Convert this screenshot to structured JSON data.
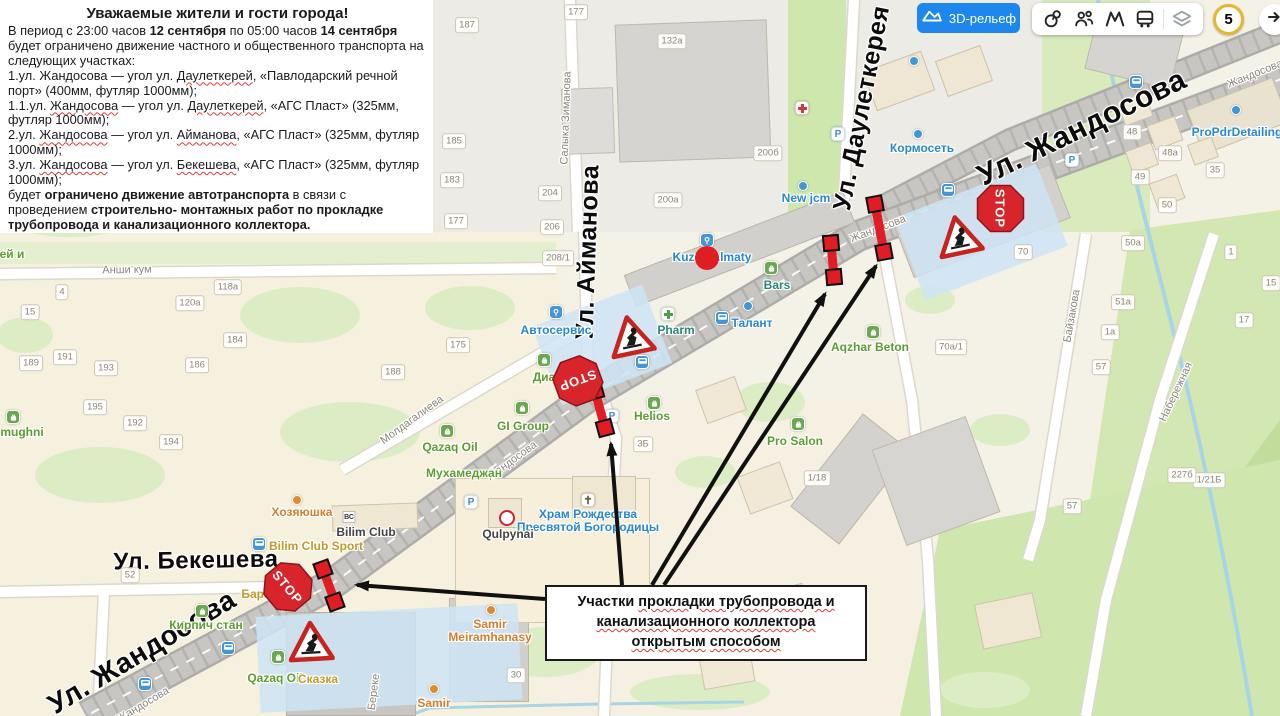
{
  "notice": {
    "title": "Уважаемые жители и гости города!",
    "paragraphs": [
      [
        {
          "t": "В период с 23:00 часов "
        },
        {
          "t": "12 сентября",
          "b": true
        },
        {
          "t": " по 05:00 часов  "
        },
        {
          "t": "14 сентября",
          "b": true
        },
        {
          "t": " будет ограничено движение частного и общественного транспорта на следующих участках:"
        }
      ],
      [
        {
          "t": "1.ул. Жандосова — угол ул. "
        },
        {
          "t": "Даулеткерей",
          "w": true
        },
        {
          "t": ", «Павлодарский речной порт» (400мм, футляр 1000мм);"
        }
      ],
      [
        {
          "t": "1.1.ул. "
        },
        {
          "t": "Жандосова",
          "w": true
        },
        {
          "t": " — угол ул. "
        },
        {
          "t": "Даулеткерей",
          "w": true
        },
        {
          "t": ", «АГС Пласт» (325мм, футляр 1000мм);"
        }
      ],
      [
        {
          "t": "2.ул. "
        },
        {
          "t": "Жандосова",
          "w": true
        },
        {
          "t": " — угол ул. "
        },
        {
          "t": "Айманова",
          "w": true
        },
        {
          "t": ", «АГС Пласт» (325мм, футляр 1000мм);"
        }
      ],
      [
        {
          "t": "3.ул. "
        },
        {
          "t": "Жандосова",
          "w": true
        },
        {
          "t": " — угол ул. "
        },
        {
          "t": "Бекешева",
          "w": true
        },
        {
          "t": ", «АГС Пласт» (325мм, футляр 1000мм);"
        }
      ],
      [
        {
          "t": "будет "
        },
        {
          "t": "ограничено движение автотранспорта",
          "b": true
        },
        {
          "t": " в связи с проведением "
        },
        {
          "t": "строительно- монтажных работ по прокладке трубопровода и канализационного коллектора.",
          "b": true
        }
      ]
    ]
  },
  "callout": {
    "lines": [
      [
        {
          "t": "Участки "
        },
        {
          "t": "прокладки трубопровода и",
          "w": true
        }
      ],
      [
        {
          "t": "канализационного коллектора",
          "w": true
        }
      ],
      [
        {
          "t": "открытым",
          "w": true
        },
        {
          "t": "  "
        },
        {
          "t": "способом",
          "w": true
        }
      ]
    ]
  },
  "toolbar": {
    "relief_label": "3D-рельеф",
    "badge_count": "5",
    "accent_blue": "#1d87ee",
    "badge_ring": "#e8b62a",
    "icons": [
      "landmarks",
      "friends",
      "metro",
      "transport",
      "layers"
    ]
  },
  "map": {
    "colors": {
      "closure_red": "#e01d23",
      "sign_red": "#d8242b",
      "arrow_black": "#111111",
      "poi_blue": "#2788cc",
      "poi_teal": "#28857a",
      "poi_green": "#5d9c30",
      "poi_yellow": "#c19a2a",
      "poi_orange": "#d07f2e",
      "poi_dark": "#444444"
    },
    "street_labels_major": [
      {
        "t": "Ул. Жандосова",
        "x": 1082,
        "y": 128,
        "r": -26,
        "s": 30
      },
      {
        "t": "Ул. Даулеткерея",
        "x": 862,
        "y": 108,
        "r": -79,
        "s": 25
      },
      {
        "t": "Ул. Айманова",
        "x": 588,
        "y": 252,
        "r": -88,
        "s": 25
      },
      {
        "t": "Ул. Бекешева",
        "x": 196,
        "y": 561,
        "r": -1,
        "s": 24
      },
      {
        "t": "Ул. Жандосова",
        "x": 142,
        "y": 652,
        "r": -31,
        "s": 28
      }
    ],
    "street_labels_minor": [
      {
        "t": "Жандосова",
        "x": 1255,
        "y": 74,
        "r": -22
      },
      {
        "t": "Жандосова",
        "x": 878,
        "y": 229,
        "r": -21
      },
      {
        "t": "Жандосова",
        "x": 512,
        "y": 461,
        "r": -36
      },
      {
        "t": "Жандосова",
        "x": 143,
        "y": 705,
        "r": -31
      },
      {
        "t": "Салыка Зиманова",
        "x": 566,
        "y": 118,
        "r": -88
      },
      {
        "t": "Анши кум",
        "x": 127,
        "y": 270,
        "r": -1
      },
      {
        "t": "Молдагалиева",
        "x": 412,
        "y": 420,
        "r": -36
      },
      {
        "t": "Байзакова",
        "x": 1072,
        "y": 316,
        "r": -80
      },
      {
        "t": "Набережная",
        "x": 1176,
        "y": 392,
        "r": -65
      },
      {
        "t": "Береке",
        "x": 374,
        "y": 692,
        "r": -83
      }
    ],
    "house_numbers": [
      {
        "n": "187",
        "x": 467,
        "y": 25
      },
      {
        "n": "185",
        "x": 454,
        "y": 141
      },
      {
        "n": "183",
        "x": 452,
        "y": 180
      },
      {
        "n": "177",
        "x": 456,
        "y": 221
      },
      {
        "n": "177",
        "x": 576,
        "y": 12
      },
      {
        "n": "132a",
        "x": 672,
        "y": 41
      },
      {
        "n": "200a",
        "x": 668,
        "y": 200
      },
      {
        "n": "200б",
        "x": 768,
        "y": 153
      },
      {
        "n": "204",
        "x": 550,
        "y": 193
      },
      {
        "n": "206",
        "x": 552,
        "y": 227
      },
      {
        "n": "208/1",
        "x": 558,
        "y": 258
      },
      {
        "n": "175",
        "x": 458,
        "y": 345
      },
      {
        "n": "188",
        "x": 393,
        "y": 372
      },
      {
        "n": "4",
        "x": 62,
        "y": 292
      },
      {
        "n": "15",
        "x": 30,
        "y": 312
      },
      {
        "n": "118a",
        "x": 228,
        "y": 287
      },
      {
        "n": "120a",
        "x": 190,
        "y": 303
      },
      {
        "n": "184",
        "x": 235,
        "y": 340
      },
      {
        "n": "189",
        "x": 31,
        "y": 363
      },
      {
        "n": "191",
        "x": 65,
        "y": 357
      },
      {
        "n": "193",
        "x": 106,
        "y": 368
      },
      {
        "n": "186",
        "x": 197,
        "y": 365
      },
      {
        "n": "195",
        "x": 95,
        "y": 407
      },
      {
        "n": "192",
        "x": 135,
        "y": 423
      },
      {
        "n": "194",
        "x": 171,
        "y": 442
      },
      {
        "n": "52",
        "x": 130,
        "y": 575
      },
      {
        "n": "48",
        "x": 1132,
        "y": 132
      },
      {
        "n": "48a",
        "x": 1170,
        "y": 153
      },
      {
        "n": "49",
        "x": 1140,
        "y": 177
      },
      {
        "n": "35",
        "x": 1215,
        "y": 170
      },
      {
        "n": "50",
        "x": 1167,
        "y": 205
      },
      {
        "n": "70",
        "x": 1023,
        "y": 252
      },
      {
        "n": "70a/1",
        "x": 951,
        "y": 347
      },
      {
        "n": "1/21Б",
        "x": 1209,
        "y": 480
      },
      {
        "n": "1/18",
        "x": 817,
        "y": 478
      },
      {
        "n": "3Б",
        "x": 643,
        "y": 444
      },
      {
        "n": "50a",
        "x": 1133,
        "y": 243
      },
      {
        "n": "51a",
        "x": 1123,
        "y": 302
      },
      {
        "n": "1a",
        "x": 1110,
        "y": 332
      },
      {
        "n": "57",
        "x": 1101,
        "y": 367
      },
      {
        "n": "1",
        "x": 1231,
        "y": 252
      },
      {
        "n": "15",
        "x": 1271,
        "y": 283
      },
      {
        "n": "17",
        "x": 1244,
        "y": 320
      },
      {
        "n": "227б",
        "x": 1182,
        "y": 475
      },
      {
        "n": "57",
        "x": 1072,
        "y": 506
      },
      {
        "n": "30",
        "x": 516,
        "y": 675
      }
    ],
    "pois": [
      {
        "t": "ProPdrDetailing",
        "x": 1237,
        "y": 126,
        "c": "blue"
      },
      {
        "t": "Кормосеть",
        "x": 922,
        "y": 142,
        "c": "blue"
      },
      {
        "t": "New jcm",
        "x": 806,
        "y": 192,
        "c": "blue"
      },
      {
        "t": "Kuzov Almaty",
        "x": 712,
        "y": 251,
        "c": "blue"
      },
      {
        "t": "Bars",
        "x": 777,
        "y": 279,
        "c": "teal"
      },
      {
        "t": "Талант",
        "x": 752,
        "y": 317,
        "c": "blue"
      },
      {
        "t": "Pharm",
        "x": 676,
        "y": 324,
        "c": "teal"
      },
      {
        "t": "Автосервис",
        "x": 556,
        "y": 324,
        "c": "blue"
      },
      {
        "t": "Диа",
        "x": 544,
        "y": 371,
        "c": "green"
      },
      {
        "t": "GI Group",
        "x": 523,
        "y": 420,
        "c": "green"
      },
      {
        "t": "Qazaq Oil",
        "x": 450,
        "y": 441,
        "c": "green"
      },
      {
        "t": "Мухамеджан",
        "x": 464,
        "y": 467,
        "c": "green"
      },
      {
        "t": "Хозяюшка",
        "x": 302,
        "y": 506,
        "c": "orange"
      },
      {
        "t": "Bilim Club",
        "x": 366,
        "y": 526,
        "c": "dark"
      },
      {
        "t": "Bilim Club Sport",
        "x": 316,
        "y": 540,
        "c": "yellow"
      },
      {
        "t": "Бара",
        "x": 256,
        "y": 588,
        "c": "yellow"
      },
      {
        "t": "Кирпич стан",
        "x": 206,
        "y": 619,
        "c": "green"
      },
      {
        "t": "Qazaq Oil",
        "x": 275,
        "y": 672,
        "c": "green"
      },
      {
        "t": "Сказка",
        "x": 318,
        "y": 673,
        "c": "yellow"
      },
      {
        "t": "Samir\nMeiramhanasy",
        "x": 490,
        "y": 618,
        "c": "orange"
      },
      {
        "t": "Samir",
        "x": 434,
        "y": 697,
        "c": "orange"
      },
      {
        "t": "Helios",
        "x": 652,
        "y": 410,
        "c": "green"
      },
      {
        "t": "Pro Salon",
        "x": 795,
        "y": 435,
        "c": "green"
      },
      {
        "t": "Aqzhar Beton",
        "x": 870,
        "y": 341,
        "c": "green"
      },
      {
        "t": "Храм Рождества\nПресвятой Богородицы",
        "x": 588,
        "y": 508,
        "c": "blue"
      },
      {
        "t": "Qulpynai",
        "x": 508,
        "y": 528,
        "c": "dark"
      },
      {
        "t": "mughni",
        "x": 22,
        "y": 426,
        "c": "green"
      },
      {
        "t": "ей и",
        "x": 12,
        "y": 248,
        "c": "green"
      }
    ],
    "stop_signs": [
      {
        "x": 974,
        "y": 182,
        "r": 90
      },
      {
        "x": 553,
        "y": 352,
        "r": 160
      },
      {
        "x": 262,
        "y": 562,
        "r": 50
      }
    ],
    "work_signs": [
      {
        "x": 936,
        "y": 214,
        "r": -12
      },
      {
        "x": 608,
        "y": 314,
        "r": -12
      },
      {
        "x": 288,
        "y": 620,
        "r": -3
      }
    ],
    "closure_segments": [
      {
        "x1": 831,
        "y1": 243,
        "x2": 834,
        "y2": 277
      },
      {
        "x1": 875,
        "y1": 204,
        "x2": 884,
        "y2": 252
      },
      {
        "x1": 595,
        "y1": 391,
        "x2": 605,
        "y2": 428
      },
      {
        "x1": 323,
        "y1": 569,
        "x2": 335,
        "y2": 602
      }
    ],
    "arrows": [
      {
        "x1": 545,
        "y1": 599,
        "x2": 357,
        "y2": 585
      },
      {
        "x1": 622,
        "y1": 585,
        "x2": 611,
        "y2": 444
      },
      {
        "x1": 652,
        "y1": 585,
        "x2": 825,
        "y2": 294
      },
      {
        "x1": 664,
        "y1": 585,
        "x2": 876,
        "y2": 266
      }
    ],
    "transit_stops": [
      [
        1136,
        82
      ],
      [
        948,
        190
      ],
      [
        722,
        318
      ],
      [
        642,
        362
      ],
      [
        259,
        544
      ],
      [
        228,
        648
      ],
      [
        145,
        684
      ]
    ],
    "parking": [
      [
        1072,
        160
      ],
      [
        838,
        134
      ],
      [
        612,
        416
      ],
      [
        471,
        502
      ]
    ],
    "dots_blue": [
      [
        914,
        61
      ],
      [
        803,
        186
      ],
      [
        918,
        134
      ],
      [
        748,
        306
      ],
      [
        1236,
        110
      ]
    ],
    "dots_orange": [
      [
        297,
        500
      ],
      [
        491,
        610
      ],
      [
        434,
        689
      ]
    ],
    "service_squares": [
      [
        707,
        240
      ],
      [
        556,
        312
      ]
    ],
    "green_squares": [
      [
        771,
        268
      ],
      [
        544,
        360
      ],
      [
        522,
        408
      ],
      [
        447,
        431
      ],
      [
        654,
        403
      ],
      [
        278,
        657
      ],
      [
        873,
        332
      ],
      [
        798,
        424
      ],
      [
        13,
        417
      ],
      [
        202,
        611
      ]
    ],
    "medical_cross": [
      [
        802,
        108
      ]
    ],
    "pharmacy_cross": [
      [
        668,
        314
      ]
    ],
    "church_icon": [
      588,
      500
    ],
    "qulpynai_logo": [
      507,
      518
    ],
    "kuzov_red_dot": [
      707,
      258
    ],
    "bc_logo": {
      "t": "ВС",
      "x": 349,
      "y": 517
    }
  }
}
